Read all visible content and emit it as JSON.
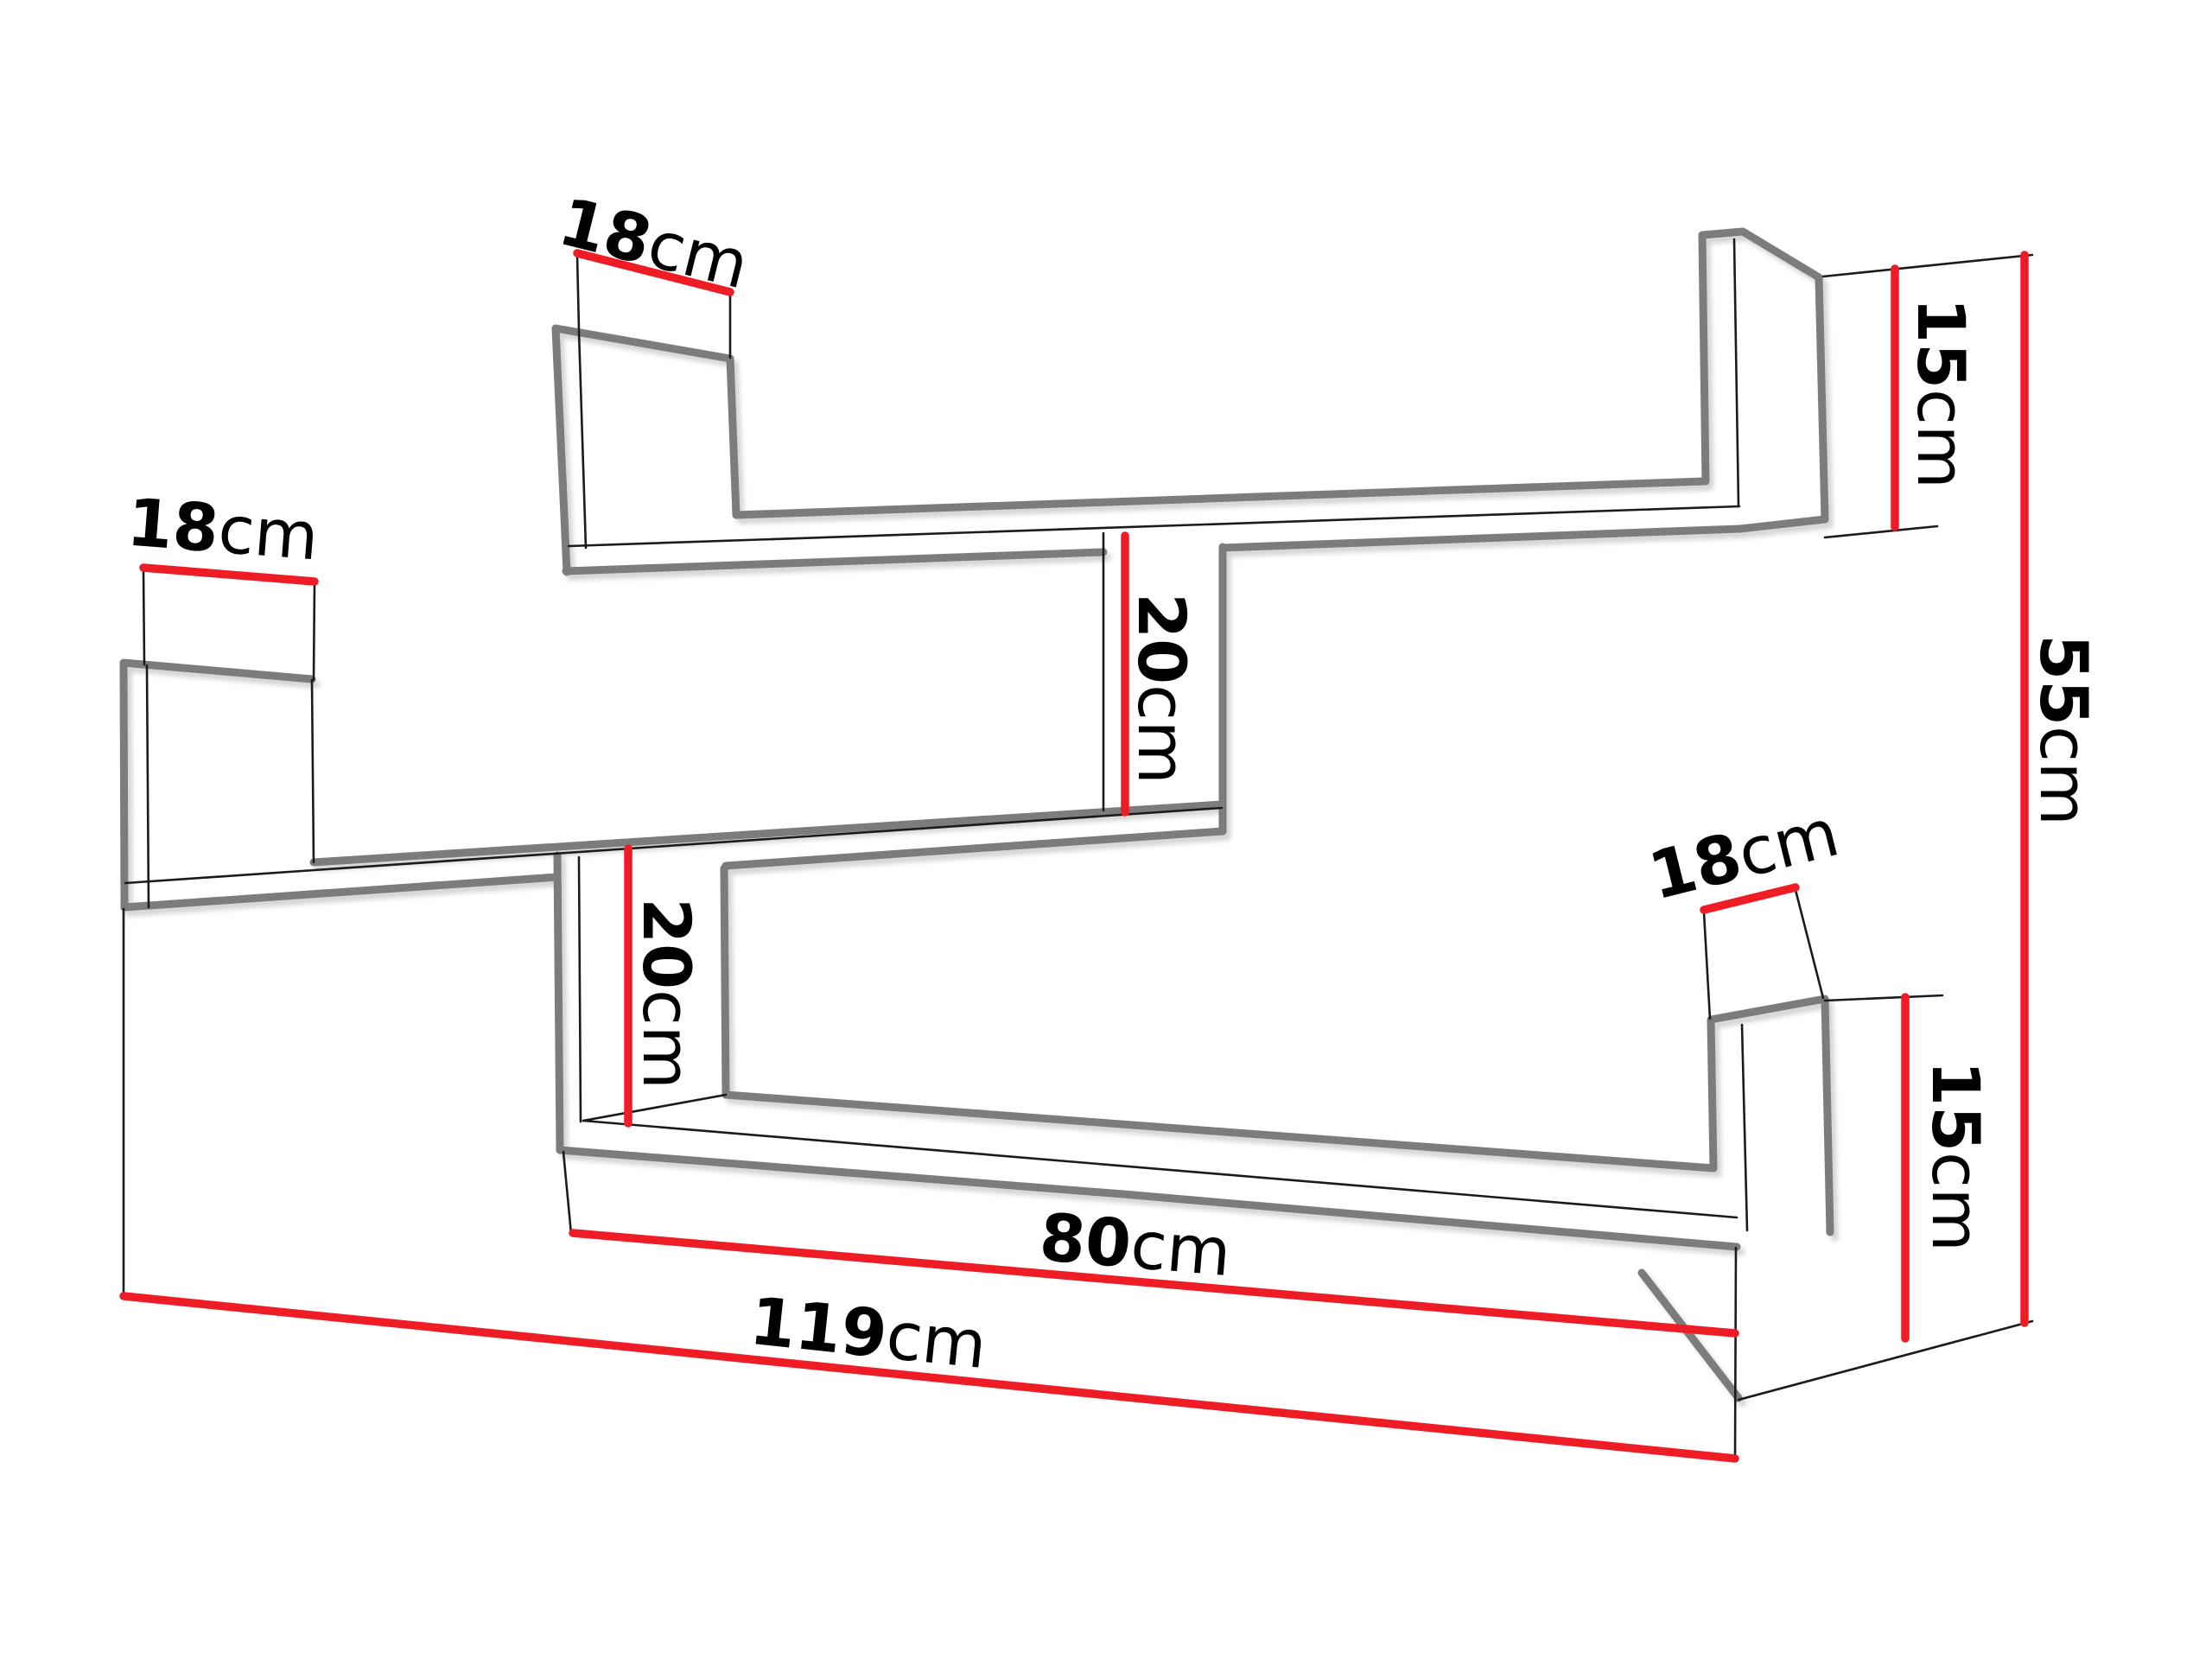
{
  "diagram": {
    "title": "wall-shelf-dimension-drawing",
    "description": "Technical dimension diagram of a three-tier zigzag wall shelf, perspective line drawing with red dimension lines",
    "colors": {
      "background": "#ffffff",
      "outline_thick": "#7c7c7c",
      "outline_thin": "#1b1b1b",
      "dimension_line": "#ee1c24",
      "label_text": "#000000"
    },
    "dims": {
      "depth_top_shelf": {
        "value": "18",
        "unit": "cm"
      },
      "depth_left_shelf": {
        "value": "18",
        "unit": "cm"
      },
      "depth_right_shelf": {
        "value": "18",
        "unit": "cm"
      },
      "side_panel_top": {
        "value": "15",
        "unit": "cm"
      },
      "side_panel_bottom": {
        "value": "15",
        "unit": "cm"
      },
      "gap_upper": {
        "value": "20",
        "unit": "cm"
      },
      "gap_lower": {
        "value": "20",
        "unit": "cm"
      },
      "total_height": {
        "value": "55",
        "unit": "cm"
      },
      "bottom_shelf_length": {
        "value": "80",
        "unit": "cm"
      },
      "total_width": {
        "value": "119",
        "unit": "cm"
      }
    }
  }
}
